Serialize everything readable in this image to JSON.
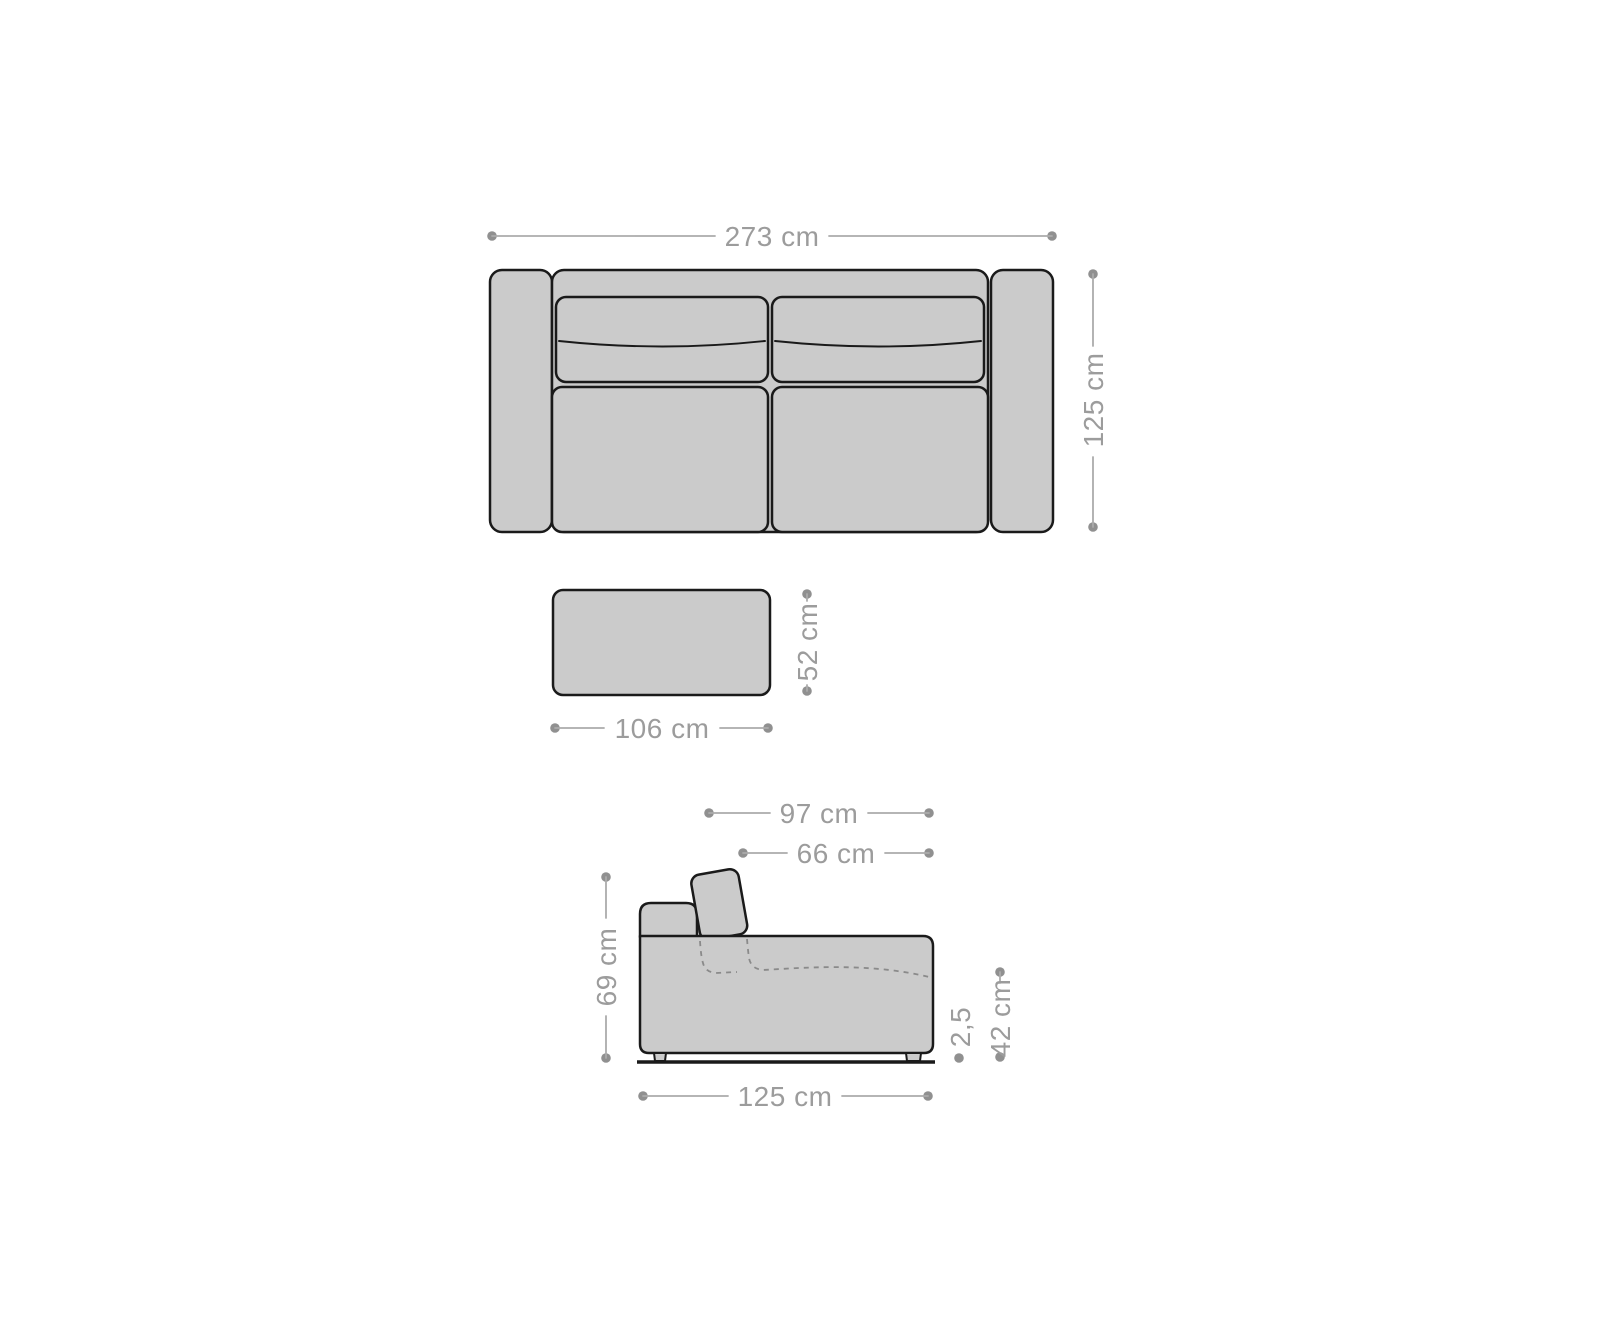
{
  "canvas": {
    "width_px": 1600,
    "height_px": 1333,
    "background": "#ffffff"
  },
  "style": {
    "furniture_fill": "#cbcbcb",
    "furniture_outline": "#1a1a1a",
    "dimension_line_color": "#ababab",
    "dimension_dot_color": "#909090",
    "dimension_text_color": "#9c9c9c",
    "hidden_edge_color": "#8a8a8a"
  },
  "diagram": {
    "kind": "sofa-dimension-drawing",
    "top_view": {
      "width_label": "273 cm",
      "depth_label": "125 cm"
    },
    "ottoman": {
      "width_label": "106 cm",
      "depth_label": "52 cm"
    },
    "side_view": {
      "depth_with_headrest_label": "97 cm",
      "seat_depth_label": "66 cm",
      "back_height_label": "69 cm",
      "seat_height_label": "42 cm",
      "foot_height_label": "2,5",
      "total_depth_label": "125 cm"
    }
  }
}
